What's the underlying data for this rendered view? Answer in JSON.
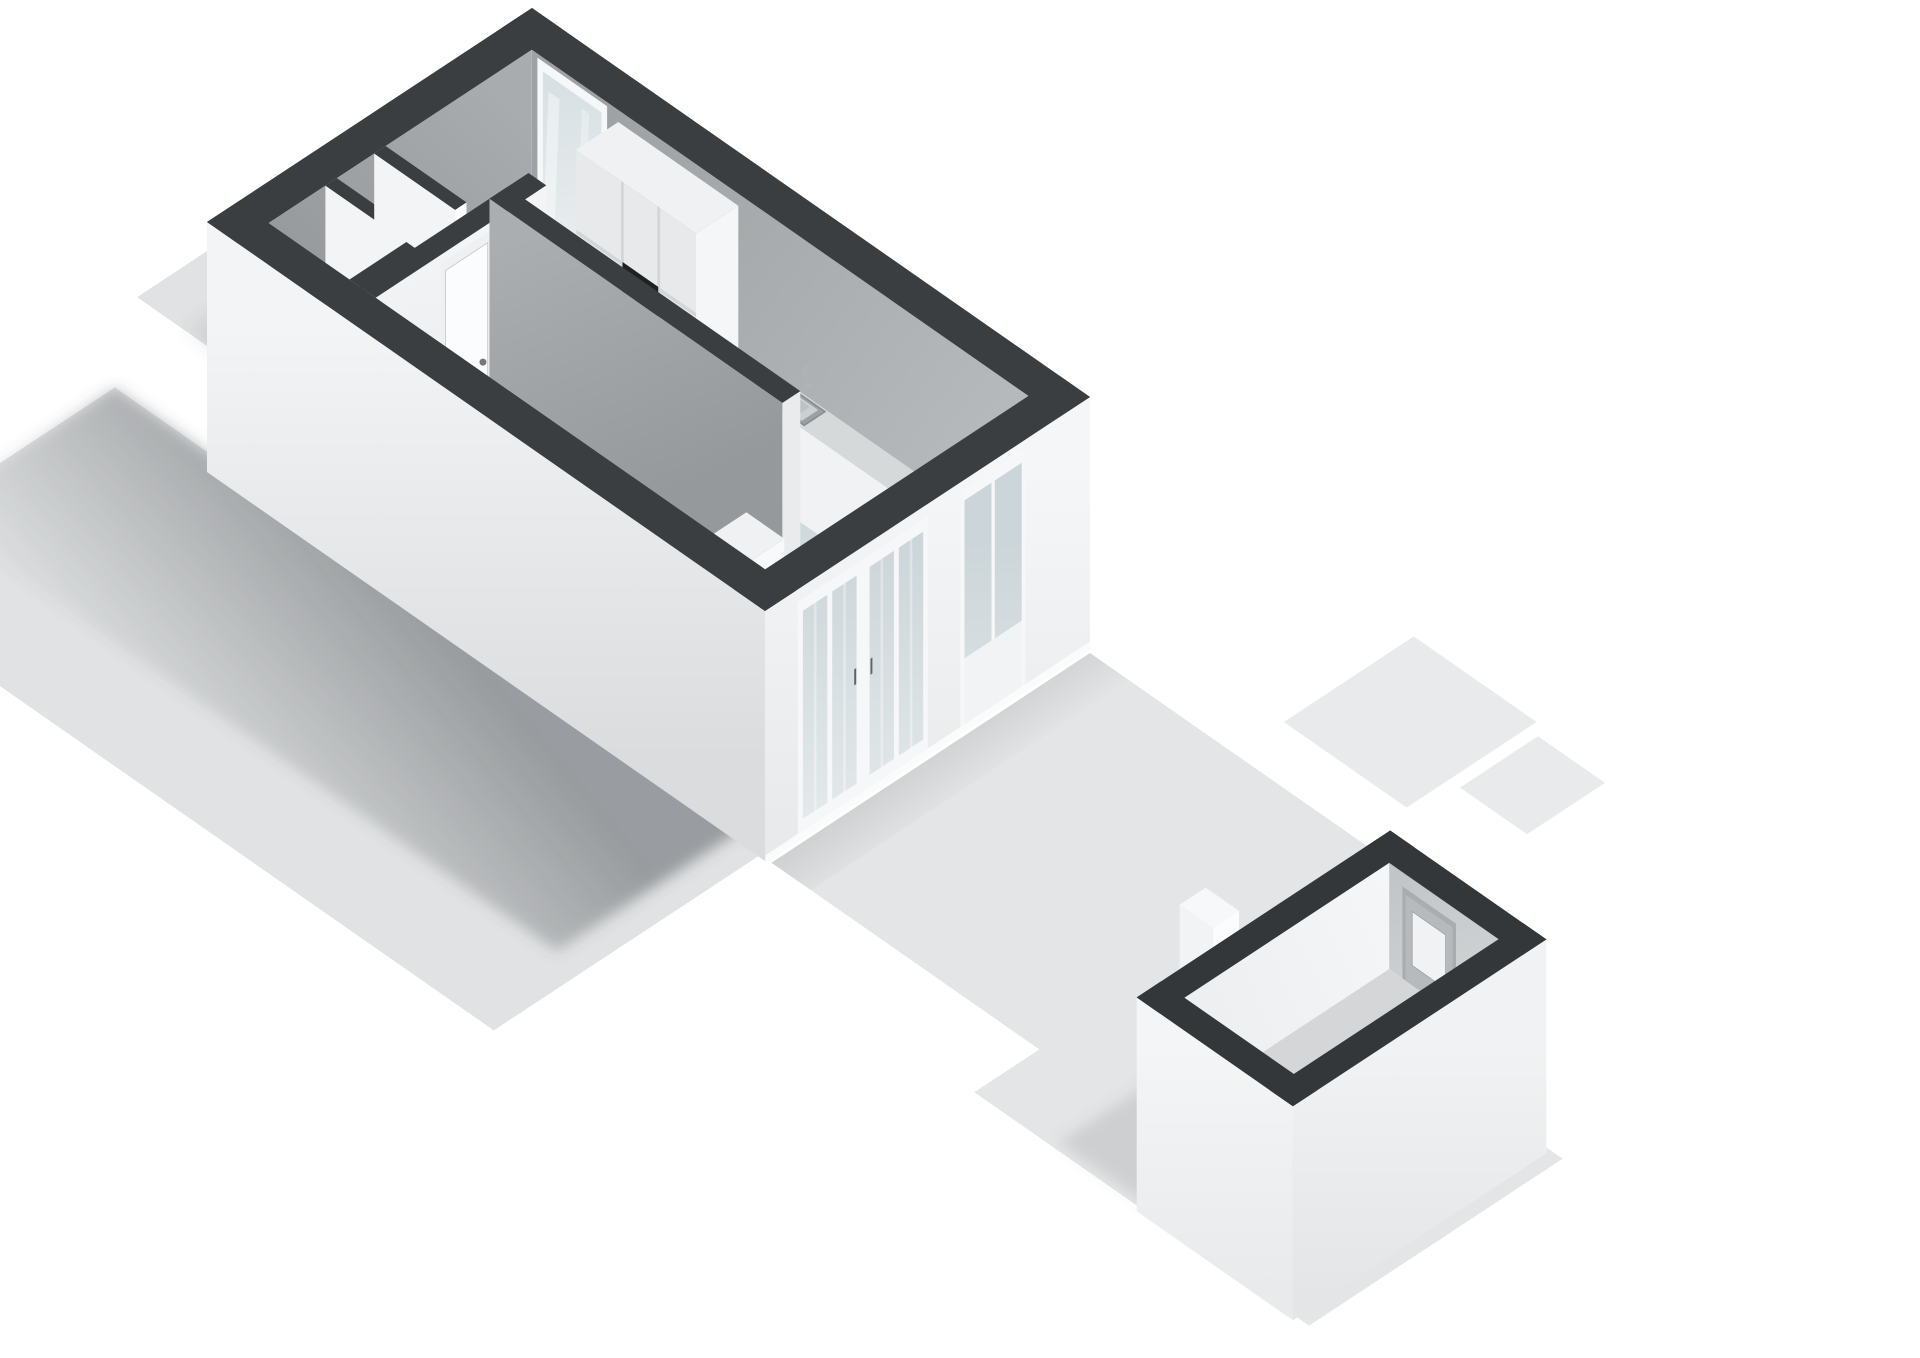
{
  "meta": {
    "kind": "3d-floorplan-render",
    "view": "axonometric-top",
    "floor": "ground-floor-with-garden-and-shed",
    "visible_text": "none"
  },
  "palette": {
    "background": "#ffffff",
    "wallTop": "#3a3e41",
    "shedWallTop": "#33373a",
    "ground": "#e0e2e3",
    "terrace": "#e4e5e6",
    "pathStrip": "#e9eaeb",
    "floorMain_a": "#c8d3d6",
    "floorMain_b": "#d7e0e2",
    "floorHall": "#eaedee",
    "floorCorridor": "#e0e4e5",
    "floorToilet": "#edeff0",
    "innerNW_a": "#8f9295",
    "innerNW_b": "#a9acae",
    "innerNE_a": "#9fa2a4",
    "innerNE_b": "#babdbf",
    "stairWall_a": "#abaeb0",
    "stairWall_b": "#96999c",
    "partition_a": "#f3f4f5",
    "partition_b": "#e6e8e9",
    "facadeSW_a": "#f3f4f5",
    "facadeSW_b": "#dadcdd",
    "facadeSE_a": "#f5f6f7",
    "facadeSE_b": "#e7e9ea",
    "frame": "#f6f7f8",
    "sill": "#fafbfb",
    "glassDoor_a": "#ccd5d9",
    "glassDoor_b": "#e6ebec",
    "glassWin_a": "#d8e0e3",
    "glassWin_b": "#eef2f3",
    "cabinetFront": "#e7e9ea",
    "cabinetEnd": "#f5f6f7",
    "cabinetTop": "#eff1f2",
    "panelLine": "#d3d6d7",
    "oven": "#1e2022",
    "ovenHandle": "#4a4e51",
    "counterTop": "#d6d9da",
    "counterFront": "#f0f2f3",
    "counterEnd": "#f8f9fa",
    "sinkRim": "#9ba0a2",
    "sinkInner": "#ccd0d2",
    "sinkBasin": "#bdc2c4",
    "faucet": "#aeb3b6",
    "stepTop": "#eff1f2",
    "stepFront": "#f8f9fa",
    "stepSide": "#e2e4e6",
    "doorLeaf": "#fbfcfd",
    "doorFrame": "#eef0f1",
    "doorHandle": "#75797c",
    "meterRed": "#84382b",
    "meterBlack": "#2b2d2f",
    "shelf": "#c9cccd",
    "toilet": "#fafbfc",
    "toiletShadow": "#d8dbdc",
    "shedFloor": "#d4d6d7",
    "shedInnerNW_a": "#edeff0",
    "shedInnerNW_b": "#f4f6f7",
    "shedInnerNE_a": "#c2c5c7",
    "shedInnerNE_b": "#d6d9da",
    "shedFacadeSW_a": "#f4f5f6",
    "shedFacadeSW_b": "#e8eaeb",
    "shedFacadeSE_a": "#f0f2f3",
    "shedFacadeSE_b": "#e3e5e6",
    "shedDoorLeaf": "#b6babc",
    "shedDoorFrame": "#a9adaf",
    "shedDoorGlass": "#f0f2f3",
    "planter": "#f2f3f4",
    "whiteBox": "#f6f8f9"
  },
  "scene": {
    "rooms": [
      {
        "name": "living-room"
      },
      {
        "name": "kitchen-zone"
      },
      {
        "name": "entrance-hall"
      },
      {
        "name": "corridor"
      },
      {
        "name": "toilet-room"
      },
      {
        "name": "staircase"
      },
      {
        "name": "meter-cupboard"
      },
      {
        "name": "storage-closet"
      }
    ],
    "fixtures": [
      {
        "name": "kitchen-tall-cabinets"
      },
      {
        "name": "built-in-oven"
      },
      {
        "name": "kitchen-counter"
      },
      {
        "name": "kitchen-sink"
      },
      {
        "name": "kitchen-faucet"
      },
      {
        "name": "utility-meters"
      },
      {
        "name": "toilet-bowl"
      },
      {
        "name": "stair-winder-steps"
      }
    ],
    "openings": [
      {
        "name": "rear-window"
      },
      {
        "name": "french-patio-doors",
        "panes": 4
      },
      {
        "name": "side-glazed-door"
      },
      {
        "name": "hall-interior-door"
      },
      {
        "name": "toilet-door"
      },
      {
        "name": "shed-glazed-door"
      }
    ],
    "outdoor": [
      {
        "name": "garden-lot"
      },
      {
        "name": "rear-terrace"
      },
      {
        "name": "shed"
      },
      {
        "name": "planter-box"
      },
      {
        "name": "neighbor-path-strips"
      }
    ]
  }
}
